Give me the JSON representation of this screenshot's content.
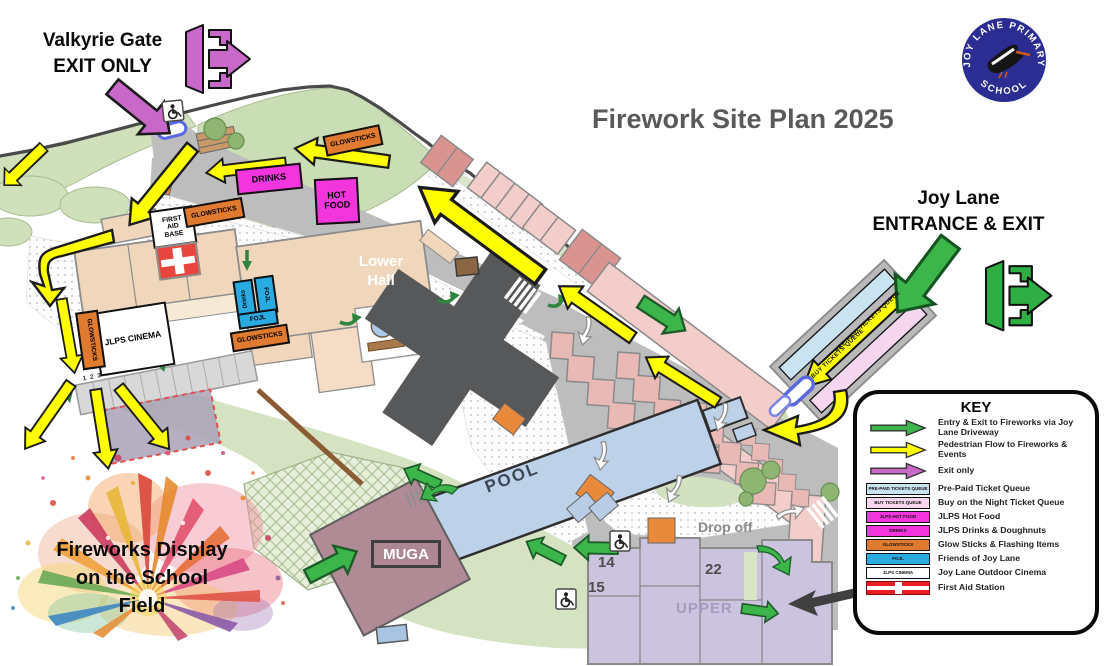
{
  "title": "Firework Site Plan 2025",
  "logo": {
    "arc_top": "JOY LANE PRIMARY",
    "arc_bottom": "SCHOOL"
  },
  "callouts": {
    "valkyrie": {
      "line1": "Valkyrie Gate",
      "line2": "EXIT ONLY"
    },
    "joy_lane": {
      "line1": "Joy Lane",
      "line2": "ENTRANCE & EXIT"
    },
    "fireworks": {
      "line1": "Fireworks Display",
      "line2": "on the School",
      "line3": "Field"
    }
  },
  "map": {
    "lower_hall": {
      "line1": "Lower",
      "line2": "Hall"
    },
    "pool": "POOL",
    "muga": "MUGA",
    "drop_off": "Drop off",
    "upper": "UPPER",
    "building_14": "14",
    "building_15": "15",
    "building_22": "22",
    "parking_numbers": "1 2 3 4 5 6 7 8 9 10",
    "first_aid": {
      "line1": "FIRST",
      "line2": "AID",
      "line3": "BASE"
    },
    "cinema": "JLPS CINEMA",
    "glowsticks": "GLOWSTICKS",
    "drinks": "DRINKS",
    "hot_food": {
      "line1": "HOT",
      "line2": "FOOD"
    },
    "fojl": "FOJL",
    "fojl_drinks": "Drinks",
    "queue_prepaid": "PRE-PAID TICKETS QUEUE",
    "queue_buy": "BUY TICKETS QUEUE"
  },
  "key": {
    "title": "KEY",
    "entries": [
      {
        "symbol": "green-arrow",
        "label": "Entry & Exit to Fireworks via Joy Lane Driveway"
      },
      {
        "symbol": "yellow-arrow",
        "label": "Pedestrian Flow to Fireworks & Events"
      },
      {
        "symbol": "purple-arrow",
        "label": "Exit only"
      },
      {
        "symbol": "swatch",
        "swatch_label": "PRE-PAID TICKETS QUEUE",
        "color": "#c9e3f1",
        "label": "Pre-Paid Ticket Queue"
      },
      {
        "symbol": "swatch",
        "swatch_label": "BUY TICKETS QUEUE",
        "color": "#f6d6ef",
        "label": "Buy on the Night Ticket Queue"
      },
      {
        "symbol": "swatch",
        "swatch_label": "JLPS HOT FOOD",
        "color": "#f335de",
        "label": "JLPS Hot Food"
      },
      {
        "symbol": "swatch",
        "swatch_label": "DRINKS",
        "color": "#f335de",
        "label": "JLPS Drinks & Doughnuts"
      },
      {
        "symbol": "swatch",
        "swatch_label": "GLOWSTICKS",
        "color": "#e07a2e",
        "label": "Glow Sticks & Flashing Items"
      },
      {
        "symbol": "swatch",
        "swatch_label": "FOJL",
        "color": "#29aae1",
        "label": "Friends of Joy Lane"
      },
      {
        "symbol": "swatch",
        "swatch_label": "JLPS CINEMA",
        "color": "#ffffff",
        "label": "Joy Lane Outdoor Cinema"
      },
      {
        "symbol": "first-aid",
        "label": "First Aid Station"
      }
    ]
  },
  "colors": {
    "entry_green": "#3cb54a",
    "pedestrian_yellow": "#ffff00",
    "exit_purple": "#c869c9",
    "first_aid_red": "#ee1c25",
    "title_gray": "#595959"
  }
}
